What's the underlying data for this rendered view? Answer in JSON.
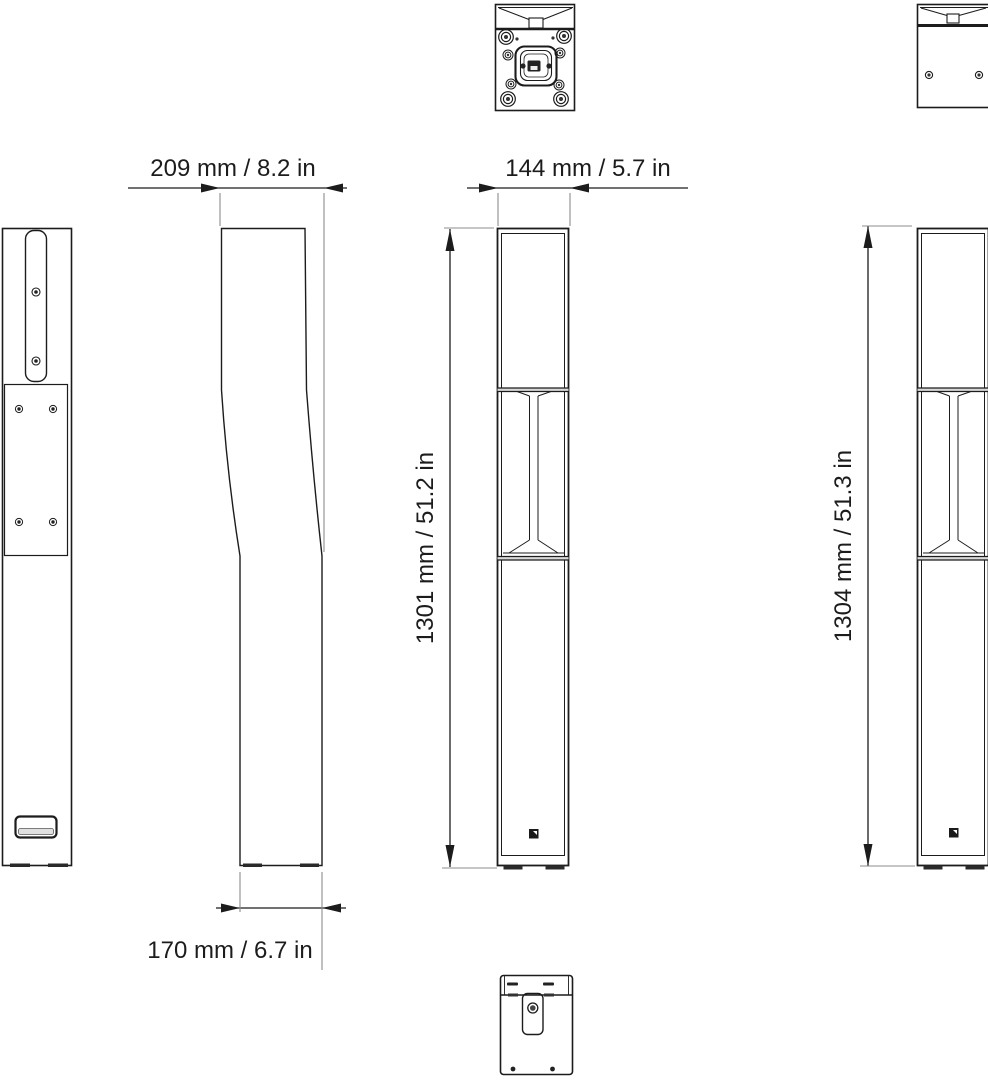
{
  "labels": {
    "depth_top": "209 mm / 8.2 in",
    "width_front": "144 mm / 5.7 in",
    "depth_bottom": "170 mm / 6.7 in",
    "height_front": "1301 mm / 51.2 in",
    "height_rear": "1304 mm / 51.3 in"
  },
  "colors": {
    "background": "#ffffff",
    "outline": "#1c1c1c",
    "dimension_line": "#8c8c8c",
    "panel_fill": "#dcdcdc",
    "text": "#1c1c1c"
  },
  "icons": {
    "screw": "concentric-circle-screw",
    "logo": "brand-mark-square",
    "arrow": "filled-dimension-arrow"
  }
}
